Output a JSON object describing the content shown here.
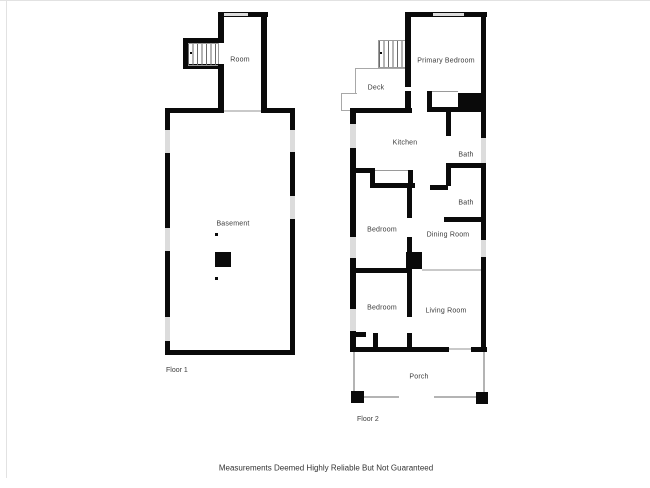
{
  "colors": {
    "wall": "#0a0a0a",
    "window": "#dcdcdc",
    "thin_line": "#c9c9c9",
    "label_text": "#3b3b3b",
    "background": "#ffffff"
  },
  "floor1": {
    "label": "Floor 1",
    "rooms": {
      "room": "Room",
      "basement": "Basement"
    }
  },
  "floor2": {
    "label": "Floor 2",
    "rooms": {
      "primary_bedroom": "Primary Bedroom",
      "deck": "Deck",
      "kitchen": "Kitchen",
      "bath1": "Bath",
      "bath2": "Bath",
      "bedroom1": "Bedroom",
      "dining_room": "Dining Room",
      "bedroom2": "Bedroom",
      "living_room": "Living Room",
      "porch": "Porch"
    }
  },
  "footer": {
    "disclaimer": "Measurements Deemed Highly Reliable But Not Guaranteed"
  }
}
